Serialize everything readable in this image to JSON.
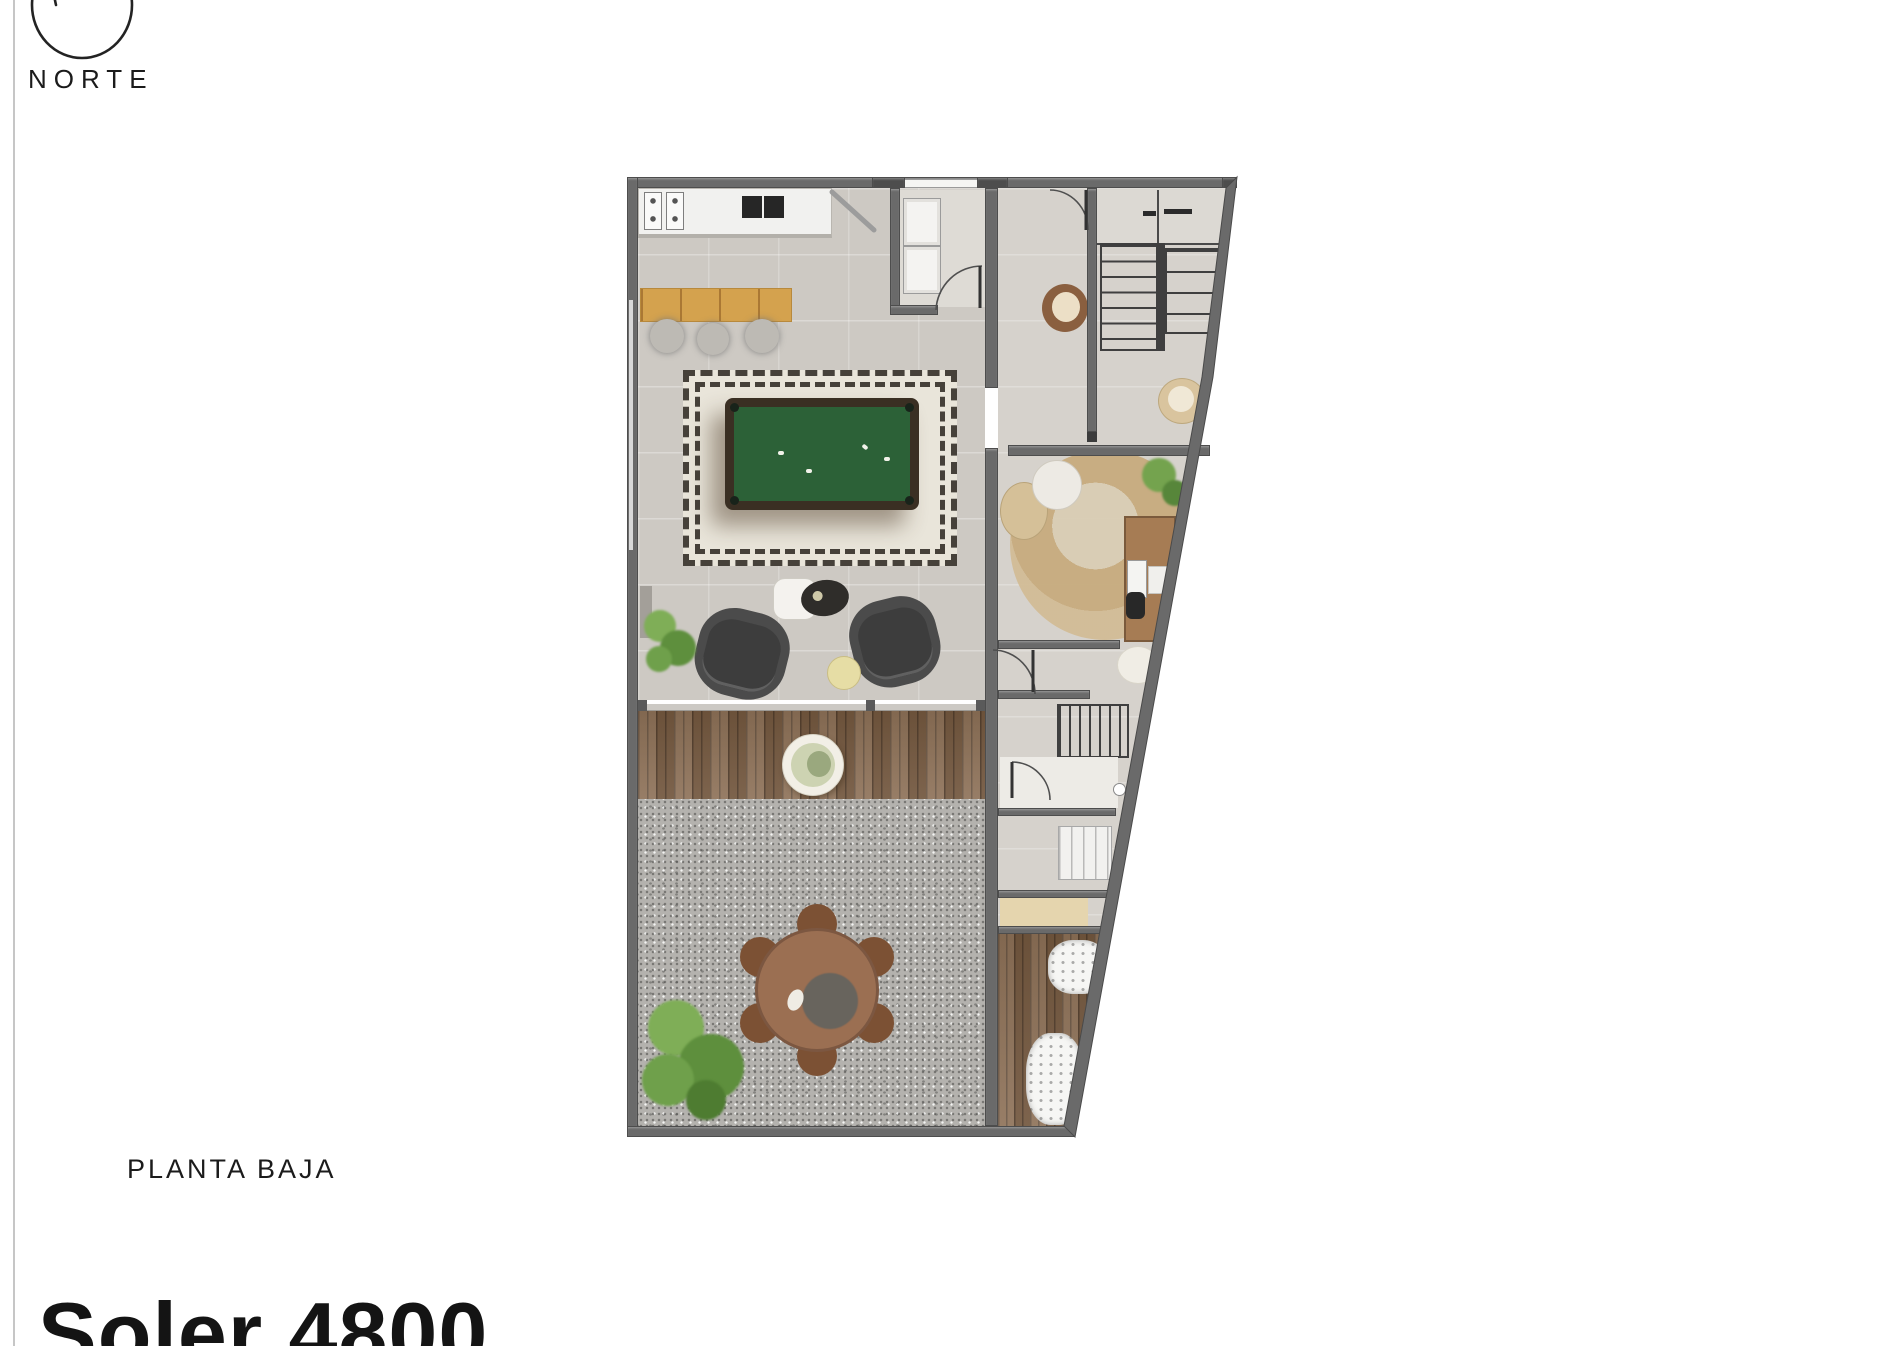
{
  "compass": {
    "label": "NORTE"
  },
  "floor_plan": {
    "label": "PLANTA BAJA"
  },
  "title": {
    "text": "Soler 4800"
  },
  "colors": {
    "ink": "#1b1b1b",
    "wall": "#6a6a6a",
    "wall-dark": "#4d4d4d",
    "floor": "#cdc9c3",
    "floor-light": "#d6d2cc",
    "rug": "#e9e5da",
    "rug-dash": "#46413a",
    "pool-felt": "#2c6137",
    "pool-frame": "#3a2f23",
    "bar-wood": "#d4a24e",
    "deck-wood": "#85664b",
    "patio": "#b4b2ae",
    "table-brown": "#9b6f52",
    "chair-brown": "#7c5134",
    "sofa-gray": "#4b4b4b",
    "plant-green": "#6f9c4a",
    "office-rug": "#c7ab7e",
    "tan": "#d9c49e"
  }
}
